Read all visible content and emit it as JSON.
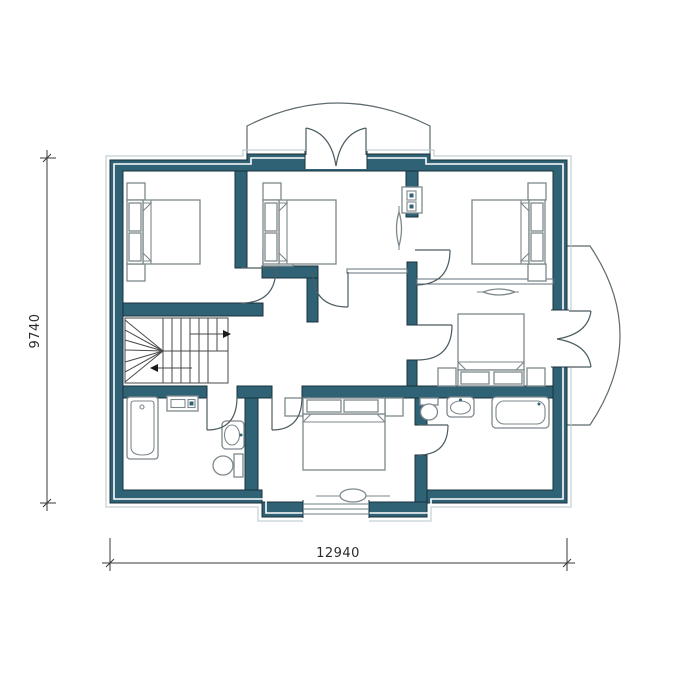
{
  "drawing_type": "house-floor-plan",
  "dimension_labels": {
    "bottom": "12940",
    "left": "9740"
  },
  "palette": {
    "background": "#ffffff",
    "wall_fill": "#306276",
    "wall_edge": "#17333f",
    "wall_insulation_line": "#ffffff",
    "outer_contour": "#b4c4cb",
    "fixture_line": "#7e888c",
    "door_arc": "#4c5c62",
    "stair_line": "#4a4a4a",
    "dimension_color": "#2b2b2b"
  },
  "fixtures": [
    {
      "name": "double-bed",
      "count": 5
    },
    {
      "name": "nightstand",
      "count": 10
    },
    {
      "name": "bathtub",
      "count": 2
    },
    {
      "name": "toilet",
      "count": 2
    },
    {
      "name": "washbasin",
      "count": 2
    },
    {
      "name": "radiator",
      "count": 3
    },
    {
      "name": "ventilation-block",
      "count": 2
    },
    {
      "name": "winder-staircase",
      "count": 1
    },
    {
      "name": "balcony",
      "count": 2
    },
    {
      "name": "french-door",
      "count": 2
    },
    {
      "name": "interior-door",
      "count": 7
    },
    {
      "name": "window",
      "count": 1
    }
  ]
}
